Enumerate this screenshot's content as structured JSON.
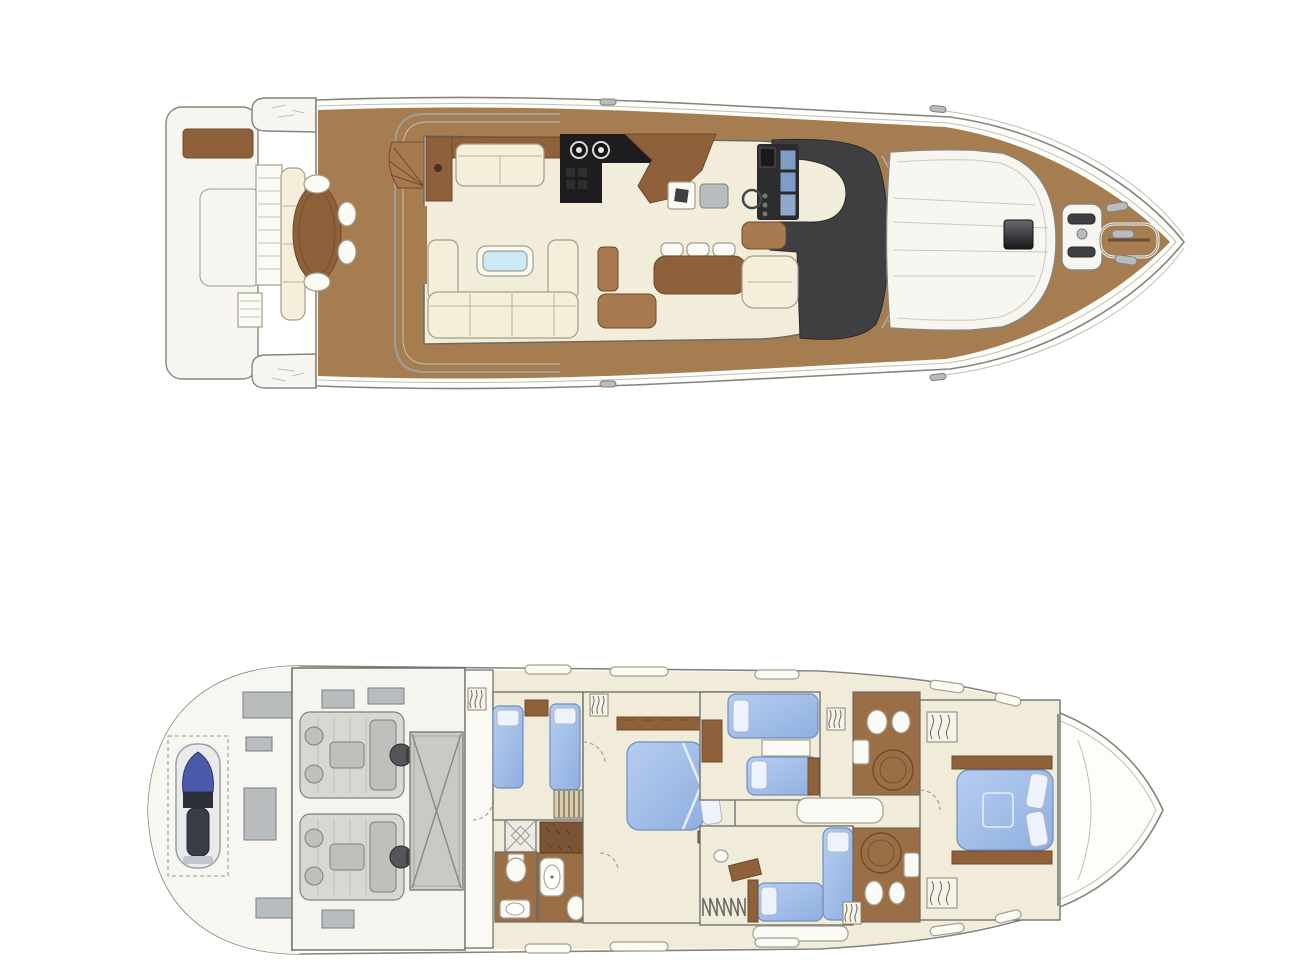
{
  "figure": {
    "kind": "yacht-floorplan",
    "views": [
      "main-deck-plan",
      "lower-deck-plan"
    ],
    "orientation": "bow-pointing-right"
  },
  "colors": {
    "bg": "#ffffff",
    "hullFill": "#fdfdf9",
    "hullStroke": "#85857f",
    "platFill": "#f6f5ef",
    "teak": "#a67d51",
    "creamFloor": "#f2ecda",
    "creamFurn": "#f4eedb",
    "white": "#fbfbf6",
    "wood": "#8f613b",
    "woodLight": "#a8794e",
    "woodDark": "#6f4a2c",
    "woodFloor": "#9b6f45",
    "furnStroke": "#a39d8c",
    "wall": "#6b6b64",
    "dark": "#3f3f42",
    "darker": "#2a2a2d",
    "black": "#1d1d1f",
    "metal": "#b9bcbe",
    "metalStroke": "#7d8082",
    "glass": "#cde9f5",
    "bedBlueLight": "#b7cdf1",
    "bedBlueDark": "#8fafdf",
    "bedStroke": "#6d8fc0",
    "pillow": "#eef2fa",
    "pillowStroke": "#aab8d0",
    "tankFill": "#c9c9c5",
    "tankStroke": "#7d7d76",
    "engFill": "#d7d7d3",
    "engInner": "#bfbfbb",
    "engStroke": "#82827a",
    "thinLine": "#c0c0b8",
    "dashCol": "#9a9a92",
    "jetskiBlue": "#4a5aaa",
    "jetskiDark": "#33363f",
    "hatchDark": "#17171a",
    "screenBlue": "#7e9cc8"
  },
  "decks": [
    {
      "id": "main-deck",
      "areas": [
        "swim-platform",
        "aft-cockpit",
        "salon",
        "galley",
        "dinette",
        "helm-station",
        "foredeck-sunpad",
        "anchor-area"
      ],
      "furniture": [
        "cockpit-table",
        "cockpit-stools",
        "stern-bench",
        "salon-sofa-forward",
        "salon-sofa-aft",
        "coffee-table",
        "galley-counter",
        "galley-island",
        "dinette-table",
        "dinette-chairs",
        "helm-console",
        "helm-seat",
        "companion-seat"
      ]
    },
    {
      "id": "lower-deck",
      "areas": [
        "tender-garage",
        "engine-room",
        "twin-cabin",
        "master-cabin",
        "master-head",
        "port-head",
        "guest-cabin-forward",
        "guest-cabin-aft",
        "starboard-head-forward",
        "starboard-head-aft",
        "vip-cabin",
        "bow-locker"
      ],
      "furniture": [
        "jet-ski",
        "port-engine",
        "starboard-engine",
        "fuel-tank",
        "twin-beds",
        "master-bed",
        "guest-beds",
        "vip-bed",
        "showers",
        "toilets",
        "vanities",
        "wardrobes",
        "companionway-stairs"
      ]
    }
  ]
}
